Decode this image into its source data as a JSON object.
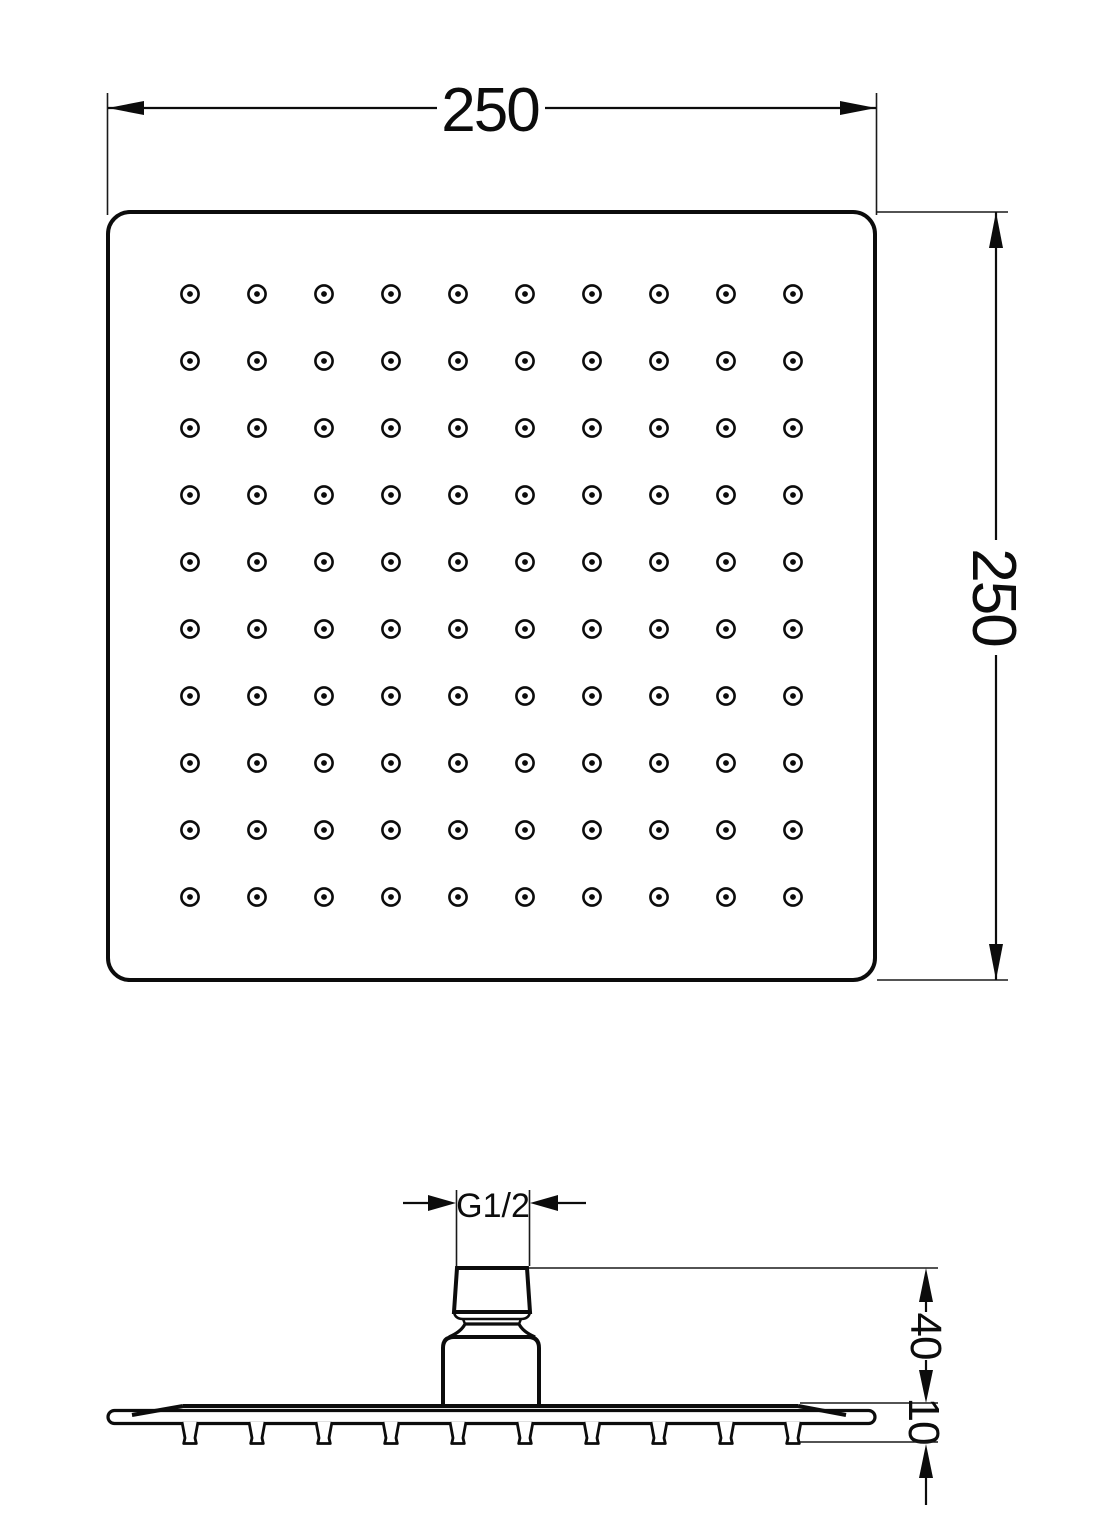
{
  "drawing": {
    "background": "#ffffff",
    "line_color": "#0c0c0c",
    "labels": {
      "width": "250",
      "height": "250",
      "thread": "G1/2",
      "connector_height": "40",
      "plate_thickness": "10"
    },
    "top_view": {
      "nozzle_grid": {
        "rows": 10,
        "columns": 10,
        "start_x": 190,
        "start_y": 294,
        "spacing_x": 67,
        "spacing_y": 67,
        "outer_radius": 8.6,
        "inner_radius": 2.9
      }
    },
    "side_view": {
      "nozzles": {
        "count": 10,
        "start_x": 190,
        "spacing": 67,
        "top_y": 1422,
        "bottom_y": 1443.5
      }
    }
  }
}
